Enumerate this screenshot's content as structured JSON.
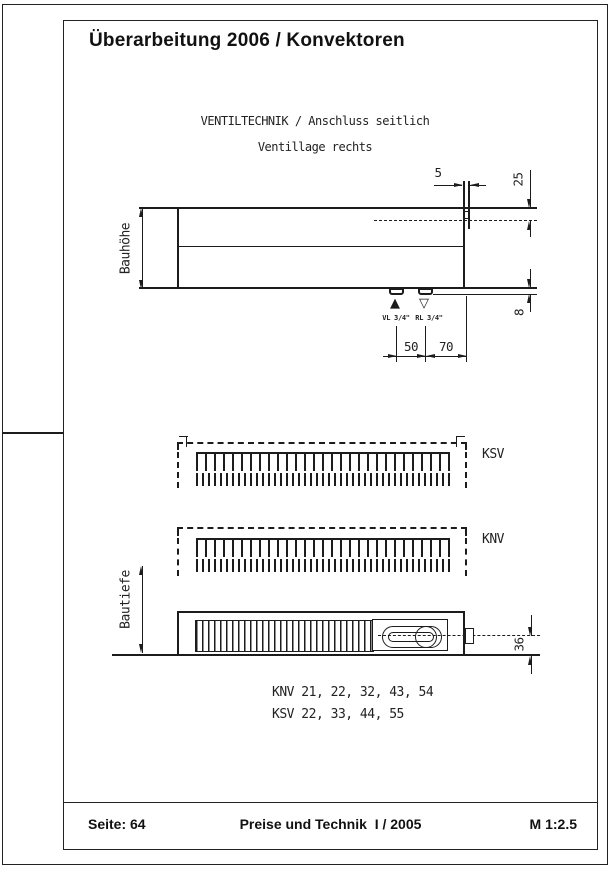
{
  "page": {
    "title": "Überarbeitung 2006 / Konvektoren",
    "drawing_title_line1": "VENTILTECHNIK / Anschluss seitlich",
    "drawing_title_line2": "Ventillage rechts"
  },
  "side_view": {
    "height_label": "Bauhöhe",
    "dims": {
      "pipe_width": "5",
      "pipe_offset": "25",
      "tab_height": "8",
      "vl_to_rl": "50",
      "rl_to_end": "70"
    },
    "supply": {
      "icon": "▲",
      "label": "VL 3/4\""
    },
    "return": {
      "icon": "▽",
      "label": "RL 3/4\""
    }
  },
  "top_views": {
    "ksv_label": "KSV",
    "knv_label": "KNV"
  },
  "plan_view": {
    "depth_label": "Bautiefe",
    "dims": {
      "center_to_front": "36"
    }
  },
  "models": {
    "knv_line": "KNV 21, 22, 32, 43, 54",
    "ksv_line": "KSV 22, 33, 44, 55"
  },
  "footer": {
    "page": "Seite: 64",
    "edition": "Preise und Technik  I / 2005",
    "scale": "M 1:2.5"
  },
  "colors": {
    "ink": "#1c1c1c",
    "paper": "#ffffff"
  }
}
